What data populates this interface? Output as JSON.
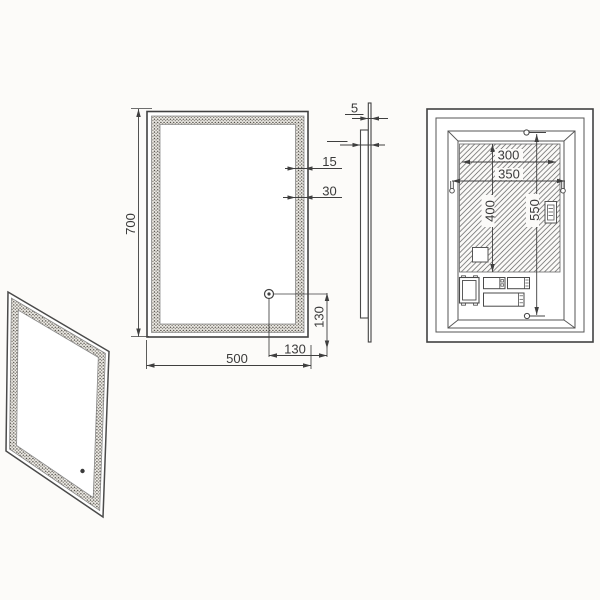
{
  "drawing": {
    "type": "technical-drawing-led-mirror",
    "views": {
      "front": {
        "height": "700",
        "width": "500",
        "sensor_offset_right": "130",
        "sensor_offset_bottom": "130",
        "edge_margin": "15",
        "frosted_band_width": "30"
      },
      "side": {
        "glass_thickness": "5",
        "total_depth": "25"
      },
      "back": {
        "led_panel_width": "300",
        "mount_bracket_span": "350",
        "led_panel_height": "400",
        "mount_bracket_vertical_span": "550"
      }
    },
    "colors": {
      "background": "#fcfbf9",
      "outline": "#414141",
      "dimension": "#3f3f3f",
      "hatch": "#5f5f5f",
      "stipple_band": "#55504a"
    }
  }
}
